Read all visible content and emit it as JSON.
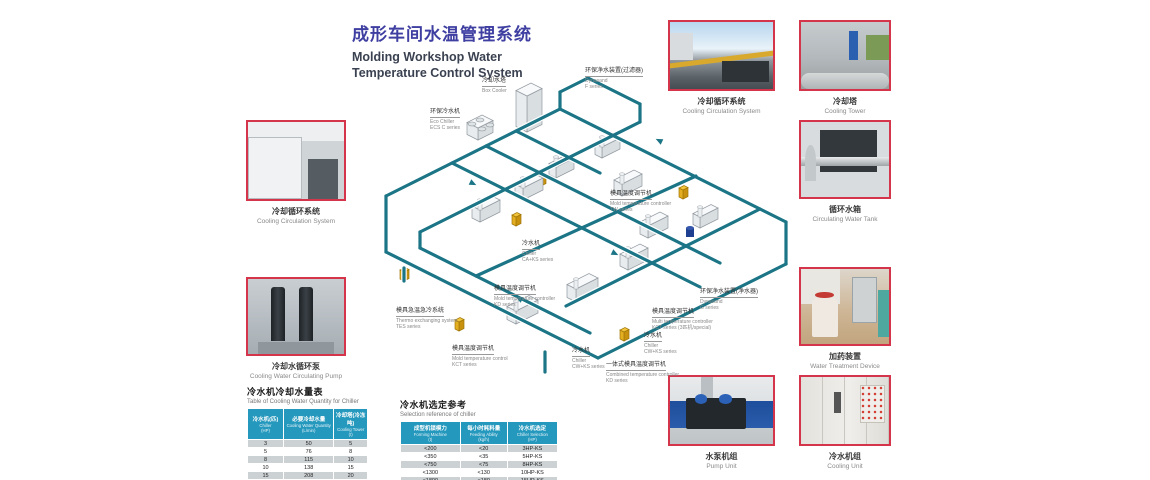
{
  "title": {
    "zh": "成形车间水温管理系统",
    "en_line1": "Molding Workshop Water",
    "en_line2": "Temperature Control System"
  },
  "photos": [
    {
      "zh": "冷却循环系统",
      "en": "Cooling Circulation System"
    },
    {
      "zh": "冷却水循环泵",
      "en": "Cooling Water Circulating Pump"
    },
    {
      "zh": "冷却循环系统",
      "en": "Cooling Circulation System"
    },
    {
      "zh": "冷却塔",
      "en": "Cooling Tower"
    },
    {
      "zh": "循环水箱",
      "en": "Circulating Water Tank"
    },
    {
      "zh": "加药装置",
      "en": "Water Treatment Device"
    },
    {
      "zh": "水泵机组",
      "en": "Pump Unit"
    },
    {
      "zh": "冷水机组",
      "en": "Cooling Unit"
    }
  ],
  "diagram": {
    "labels": [
      {
        "zh": "环保净水装置(过滤器)",
        "en": "Dynasand",
        "series": "F series"
      },
      {
        "zh": "冷却水塔",
        "en": "Box Cooler",
        "series": ""
      },
      {
        "zh": "环保冷水机",
        "en": "Eco Chiller",
        "series": "ECS C series"
      },
      {
        "zh": "模具温度调节机",
        "en": "Mold temperature controller",
        "series": "TW series"
      },
      {
        "zh": "冷水机",
        "en": "Chiller",
        "series": "CA+KS series"
      },
      {
        "zh": "模具温度调节机",
        "en": "Mold temperature controller",
        "series": "KD series"
      },
      {
        "zh": "模具急温急冷系统",
        "en": "Thermo exchanging system",
        "series": "TES series"
      },
      {
        "zh": "模具温度调节机",
        "en": "Mold temperature control",
        "series": "KCT series"
      },
      {
        "zh": "环保净水装置(净水器)",
        "en": "Dynasand",
        "series": "G series"
      },
      {
        "zh": "模具温度调节机",
        "en": "Multi temperature controller",
        "series": "KCT series (3匹机/special)"
      },
      {
        "zh": "冷水机",
        "en": "Chiller",
        "series": "CW+KS series"
      },
      {
        "zh": "一体式模具温度调节机",
        "en": "Combined temperature controller",
        "series": "KD series"
      },
      {
        "zh": "冷水机",
        "en": "Chiller",
        "series": "CW+KS series"
      }
    ]
  },
  "tables": {
    "left": {
      "title_zh": "冷水机冷却水量表",
      "title_en": "Table of Cooling Water Quantity for Chiller",
      "headers": [
        {
          "zh": "冷水机(匹)",
          "en": "Chiller",
          "unit": "(HP)"
        },
        {
          "zh": "必要冷却水量",
          "en": "Cooling Water Quantity",
          "unit": "(L/min)"
        },
        {
          "zh": "冷却塔(冷冻吨)",
          "en": "Cooling Tower",
          "unit": "(t)"
        }
      ],
      "rows": [
        [
          "3",
          "50",
          "5"
        ],
        [
          "5",
          "76",
          "8"
        ],
        [
          "8",
          "115",
          "10"
        ],
        [
          "10",
          "138",
          "15"
        ],
        [
          "15",
          "208",
          "20"
        ],
        [
          "20",
          "276",
          "25"
        ],
        [
          "30",
          "417",
          "40"
        ]
      ]
    },
    "right": {
      "title_zh": "冷水机选定参考",
      "title_en": "Selection reference of chiller",
      "headers": [
        {
          "zh": "成型机锁模力",
          "en": "Forming Machine",
          "unit": "(t)"
        },
        {
          "zh": "每小时耗料量",
          "en": "Feeding Ability",
          "unit": "(kg/h)"
        },
        {
          "zh": "冷水机选定",
          "en": "Chiller Selection",
          "unit": "(HP)"
        }
      ],
      "rows": [
        [
          "<200",
          "<20",
          "3HP-KS"
        ],
        [
          "<350",
          "<35",
          "5HP-KS"
        ],
        [
          "<750",
          "<75",
          "8HP-KS"
        ],
        [
          "<1300",
          "<130",
          "10HP-KS"
        ],
        [
          "<1800",
          "<180",
          "15HP-KS"
        ],
        [
          "<2500",
          "<250",
          "20HP-KS"
        ],
        [
          "<4000",
          "<400",
          "30HP-KS"
        ]
      ]
    }
  },
  "colors": {
    "accent_red": "#d5354a",
    "title_purple": "#3f3fa2",
    "table_header_blue": "#2598bd",
    "pipe_teal": "#1b7586",
    "machine_yellow": "#f2c53d"
  }
}
